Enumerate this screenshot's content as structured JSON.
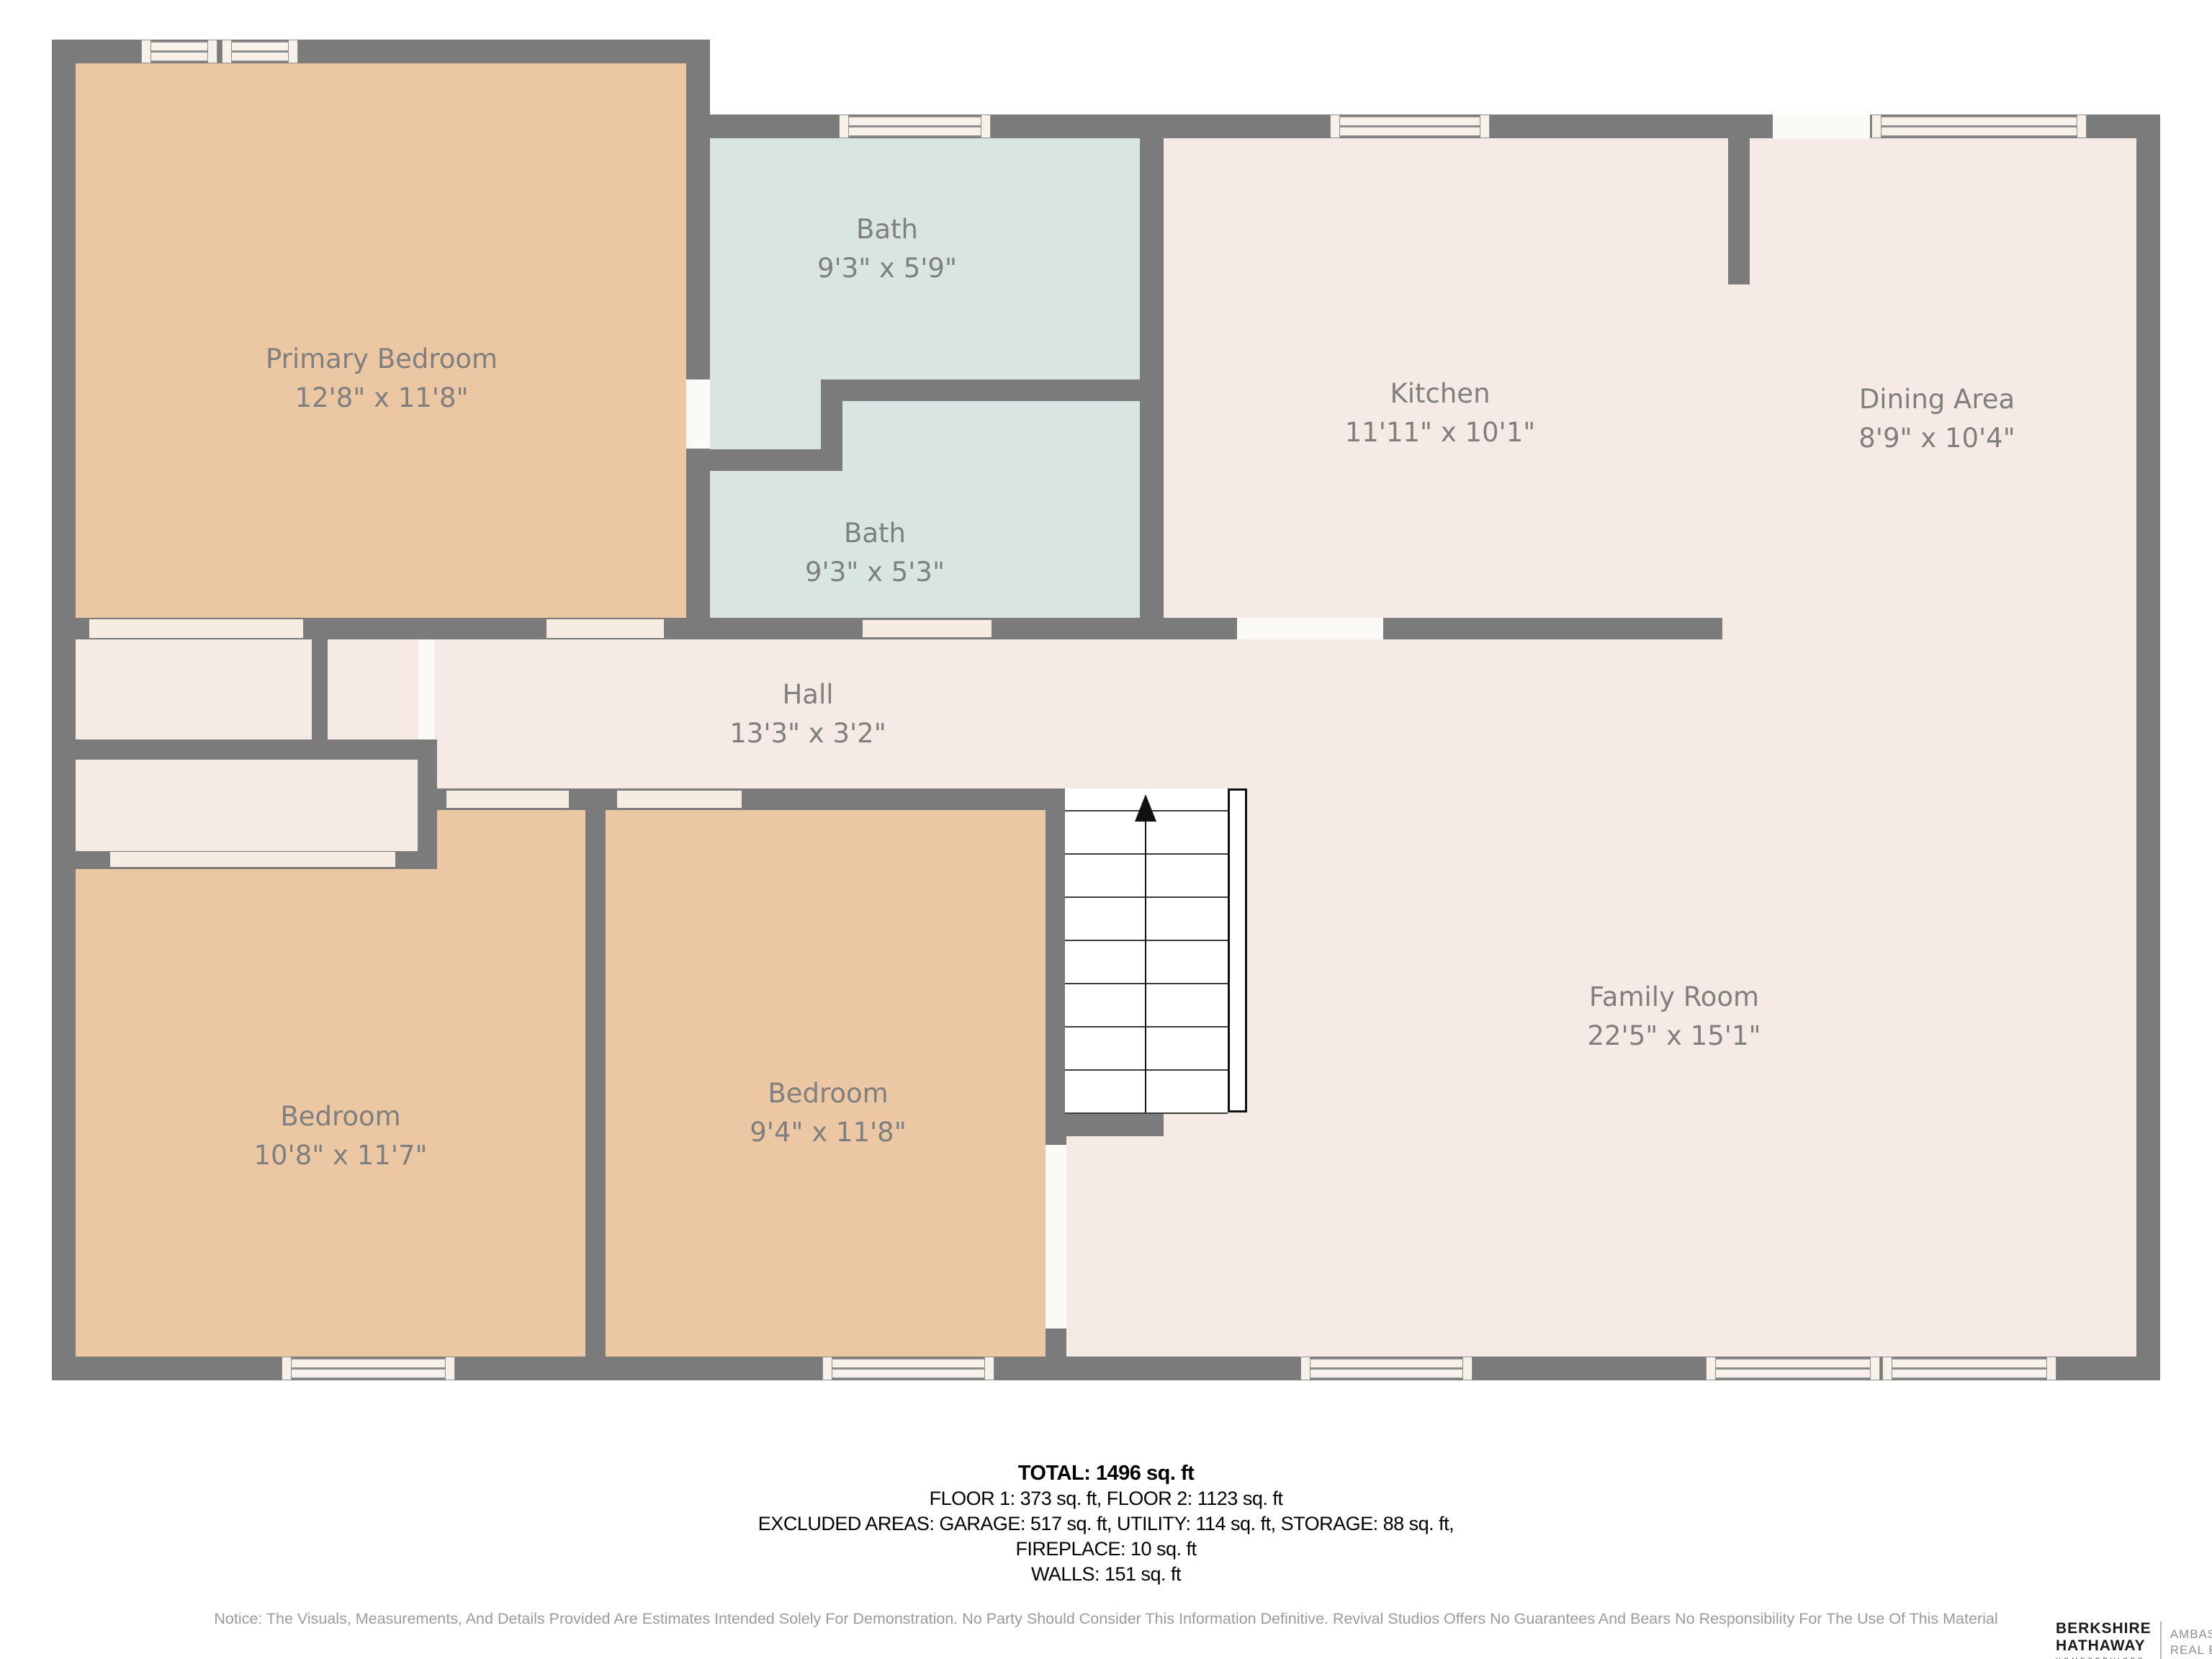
{
  "plan": {
    "rooms": [
      {
        "name": "Primary Bedroom",
        "dims": "12'8\" x 11'8\""
      },
      {
        "name": "Bath",
        "dims": "9'3\" x 5'9\""
      },
      {
        "name": "Bath",
        "dims": "9'3\" x 5'3\""
      },
      {
        "name": "Kitchen",
        "dims": "11'11\" x 10'1\""
      },
      {
        "name": "Dining Area",
        "dims": "8'9\" x 10'4\""
      },
      {
        "name": "Hall",
        "dims": "13'3\" x 3'2\""
      },
      {
        "name": "Bedroom",
        "dims": "10'8\" x 11'7\""
      },
      {
        "name": "Bedroom",
        "dims": "9'4\" x 11'8\""
      },
      {
        "name": "Family Room",
        "dims": "22'5\" x 15'1\""
      }
    ],
    "colors": {
      "wall": "#7b7b7b",
      "bedroom_fill": "#ecc7a4",
      "bath_fill": "#d8e5e3",
      "living_fill": "#f6ebe4",
      "window_fill": "#f8f1e9",
      "label_text": "#7f7f7f"
    }
  },
  "summary": {
    "total": "TOTAL: 1496 sq. ft",
    "floors": "FLOOR 1: 373 sq. ft, FLOOR 2: 1123 sq. ft",
    "excluded": "EXCLUDED AREAS: GARAGE: 517 sq. ft, UTILITY: 114 sq. ft, STORAGE: 88 sq. ft,",
    "fireplace": "FIREPLACE: 10 sq. ft",
    "walls": "WALLS: 151 sq. ft"
  },
  "notice": "Notice: The Visuals, Measurements, And Details Provided Are Estimates Intended Solely For Demonstration. No Party Should Consider This Information Definitive. Revival Studios Offers No Guarantees And Bears No Responsibility For The Use Of This Material",
  "logo": {
    "line1": "BERKSHIRE",
    "line2": "HATHAWAY",
    "line3": "HOMESERVICES",
    "right1": "AMBASSADOR",
    "right2": "REAL ESTATE"
  }
}
